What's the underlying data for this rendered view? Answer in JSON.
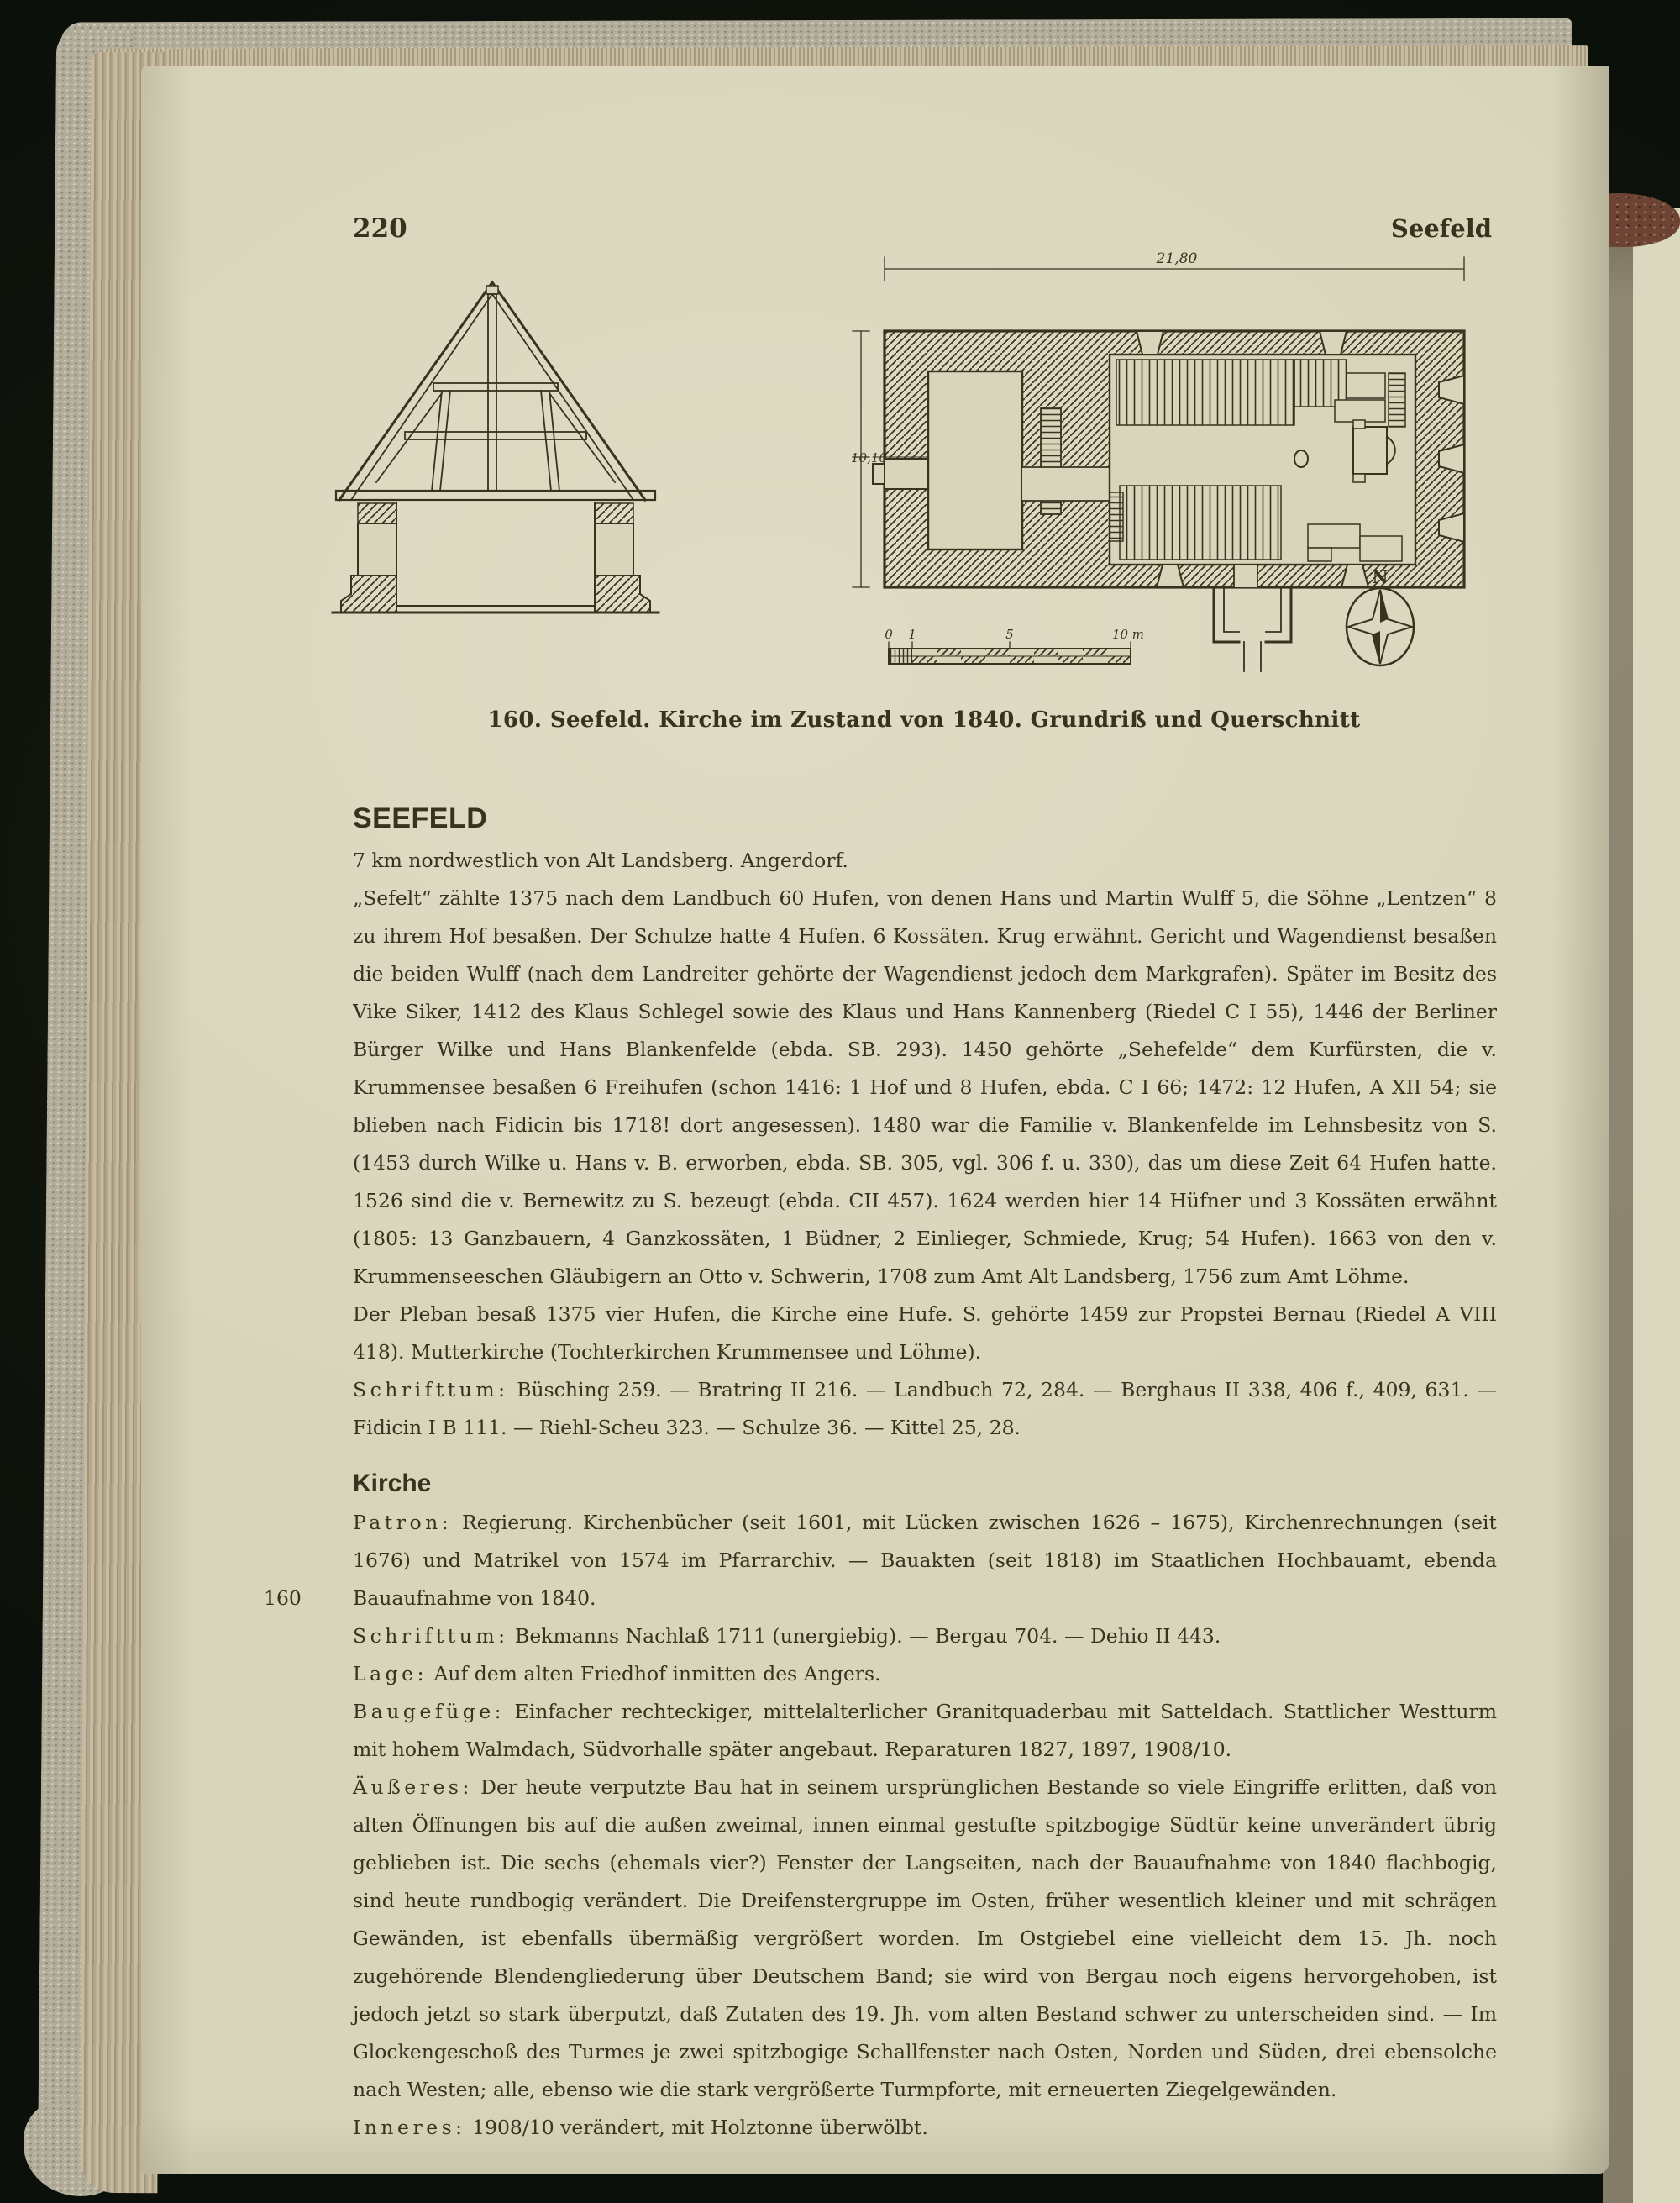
{
  "book": {
    "page_number": "220",
    "running_title": "Seefeld"
  },
  "figure": {
    "caption": "160. Seefeld. Kirche im Zustand von 1840. Grundriß und Querschnitt",
    "plan": {
      "width_dimension": "21,80",
      "height_dimension": "10,10",
      "compass_label": "N",
      "scale": {
        "zero": "0",
        "one": "1",
        "five": "5",
        "ten": "10 m"
      }
    }
  },
  "entry": {
    "title": "SEEFELD",
    "intro": "7 km nordwestlich von Alt Landsberg. Angerdorf.",
    "history": "„Sefelt“ zählte 1375 nach dem Landbuch 60 Hufen, von denen Hans und Martin Wulff 5, die Söhne „Lentzen“ 8 zu ihrem Hof besaßen. Der Schulze hatte 4 Hufen. 6 Kossäten. Krug erwähnt. Gericht und Wagendienst besaßen die beiden Wulff (nach dem Landreiter gehörte der Wagendienst jedoch dem Markgrafen). Später im Besitz des Vike Siker, 1412 des Klaus Schlegel sowie des Klaus und Hans Kannenberg (Riedel C I 55), 1446 der Berliner Bürger Wilke und Hans Blankenfelde (ebda. SB. 293). 1450 gehörte „Sehefelde“ dem Kurfürsten, die v. Krummensee besaßen 6 Freihufen (schon 1416: 1 Hof und 8 Hufen, ebda. C I 66; 1472: 12 Hufen, A XII 54; sie blieben nach Fidicin bis 1718! dort angesessen). 1480 war die Familie v. Blankenfelde im Lehnsbesitz von S. (1453 durch Wilke u. Hans v. B. erworben, ebda. SB. 305, vgl. 306 f. u. 330), das um diese Zeit 64 Hufen hatte. 1526 sind die v. Bernewitz zu S. bezeugt (ebda. CII 457). 1624 werden hier 14 Hüfner und 3 Kossäten erwähnt (1805: 13 Ganzbauern, 4 Ganzkossäten, 1 Büdner, 2 Einlieger, Schmiede, Krug; 54 Hufen). 1663 von den v. Krummenseeschen Gläubigern an Otto v. Schwerin, 1708 zum Amt Alt Landsberg, 1756 zum Amt Löhme.",
    "pleban": "Der Pleban besaß 1375 vier Hufen, die Kirche eine Hufe. S. gehörte 1459 zur Propstei Bernau (Riedel A VIII 418). Mutterkirche (Tochterkirchen Krummensee und Löhme).",
    "schrifttum_label": "Schrifttum:",
    "schrifttum": " Büsching 259. — Bratring II 216. — Landbuch 72, 284. — Berghaus II 338, 406 f., 409, 631. — Fidicin I B 111. — Riehl-Scheu 323. — Schulze 36. — Kittel 25, 28."
  },
  "kirche": {
    "title": "Kirche",
    "patron_label": "Patron:",
    "patron": " Regierung. Kirchenbücher (seit 1601, mit Lücken zwischen 1626 – 1675), Kirchenrechnungen (seit 1676) und Matrikel von 1574 im Pfarrarchiv. — Bauakten (seit 1818) im Staatlichen Hochbauamt, ebenda Bauaufnahme von 1840.",
    "margin_number": "160",
    "schrifttum_label": "Schrifttum:",
    "schrifttum": " Bekmanns Nachlaß 1711 (unergiebig). — Bergau 704. — Dehio II 443.",
    "lage_label": "Lage:",
    "lage": " Auf dem alten Friedhof inmitten des Angers.",
    "baugefuege_label": "Baugefüge:",
    "baugefuege": " Einfacher rechteckiger, mittelalterlicher Granitquaderbau mit Satteldach. Stattlicher Westturm mit hohem Walmdach, Südvorhalle später angebaut. Reparaturen 1827, 1897, 1908/10.",
    "aeusseres_label": "Äußeres:",
    "aeusseres": " Der heute verputzte Bau hat in seinem ursprünglichen Bestande so viele Eingriffe erlitten, daß von alten Öffnungen bis auf die außen zweimal, innen einmal gestufte spitzbogige Südtür keine unverändert übrig geblieben ist. Die sechs (ehemals vier?) Fenster der Langseiten, nach der Bauaufnahme von 1840 flachbogig, sind heute rundbogig verändert. Die Dreifenstergruppe im Osten, früher wesentlich kleiner und mit schrägen Gewänden, ist ebenfalls übermäßig vergrößert worden. Im Ostgiebel eine vielleicht dem 15. Jh. noch zugehörende Blendengliederung über Deutschem Band; sie wird von Bergau noch eigens hervorgehoben, ist jedoch jetzt so stark überputzt, daß Zutaten des 19. Jh. vom alten Bestand schwer zu unterscheiden sind. — Im Glockengeschoß des Turmes je zwei spitzbogige Schallfenster nach Osten, Norden und Süden, drei ebensolche nach Westen; alle, ebenso wie die stark vergrößerte Turmpforte, mit erneuerten Ziegelgewänden.",
    "inneres_label": "Inneres:",
    "inneres": " 1908/10 verändert, mit Holztonne überwölbt."
  }
}
